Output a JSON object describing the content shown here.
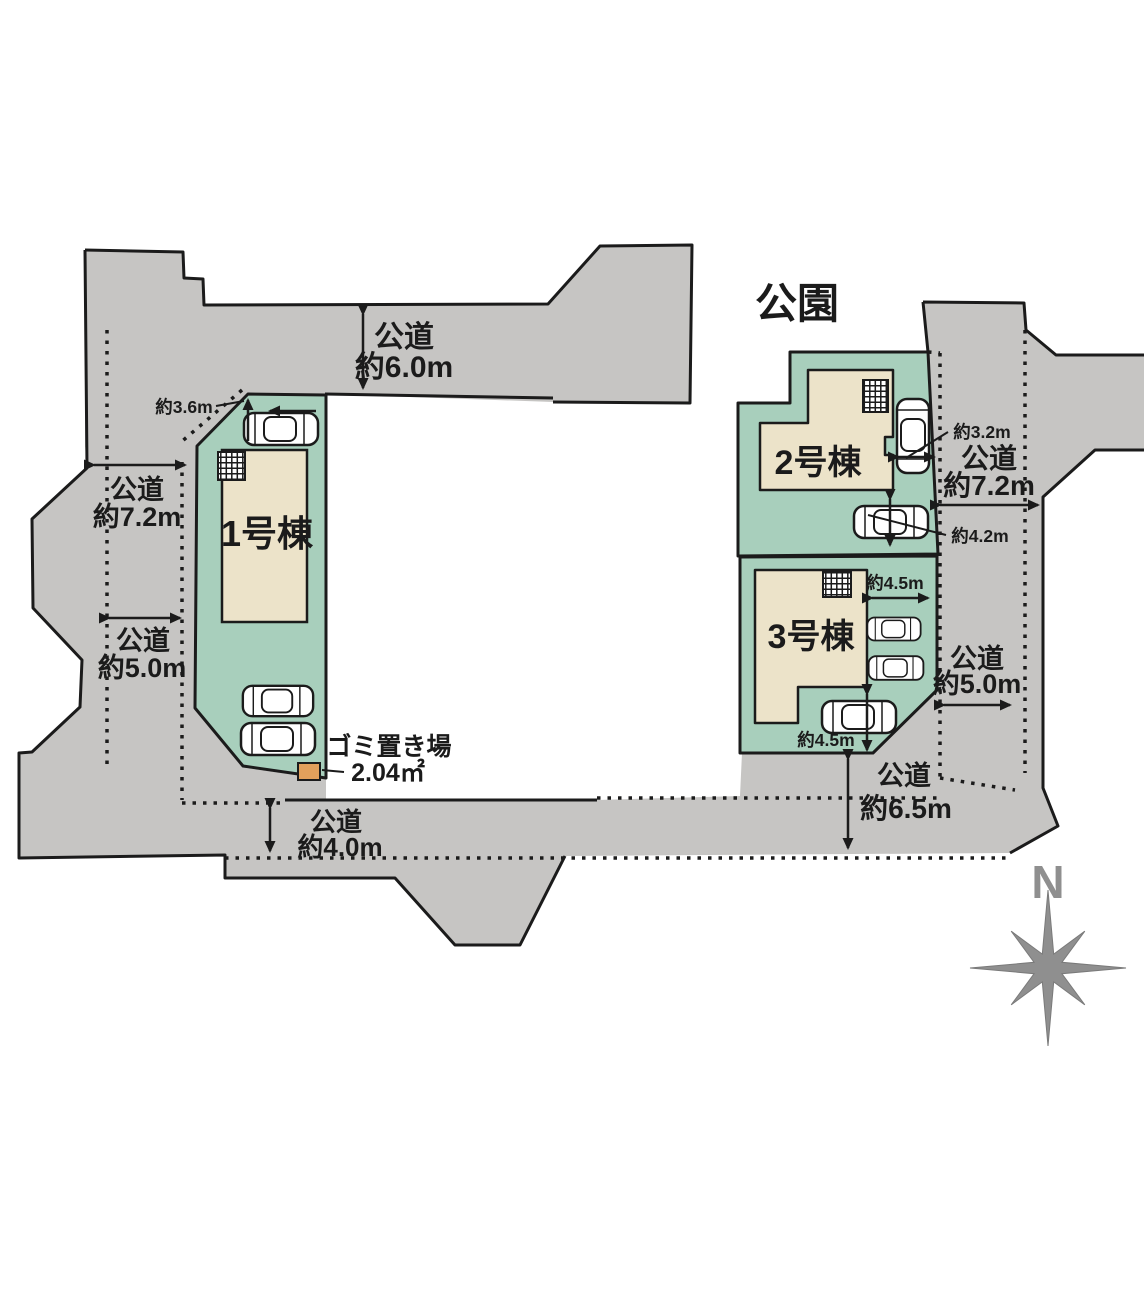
{
  "plan": {
    "park_label": "公園",
    "compass": {
      "north_label": "N"
    },
    "roads": {
      "top": {
        "name": "公道",
        "width": "約6.0m"
      },
      "left_upper": {
        "name": "公道",
        "width": "約7.2m"
      },
      "left_lower": {
        "name": "公道",
        "width": "約5.0m"
      },
      "right_upper": {
        "name": "公道",
        "width": "約7.2m"
      },
      "right_lower": {
        "name": "公道",
        "width": "約5.0m"
      },
      "bottom": {
        "name": "公道",
        "width": "約4.0m"
      },
      "bottom_right": {
        "name": "公道",
        "width": "約6.5m"
      }
    },
    "lots": {
      "lot1": {
        "label": "1号棟",
        "frontage": "約3.6m"
      },
      "lot2": {
        "label": "2号棟",
        "parking_width": "約3.2m",
        "parking_depth": "約4.2m"
      },
      "lot3": {
        "label": "3号棟",
        "parking_width_top": "約4.5m",
        "parking_width_bottom": "約4.5m"
      }
    },
    "garbage": {
      "label": "ゴミ置き場",
      "area": "2.04㎡"
    },
    "colors": {
      "road": "#c6c5c3",
      "lot_green": "#a8cfbc",
      "building": "#ece3c9",
      "garbage_box": "#e2a05c",
      "outline": "#1b1b1b",
      "compass": "#8f8f8f"
    }
  }
}
